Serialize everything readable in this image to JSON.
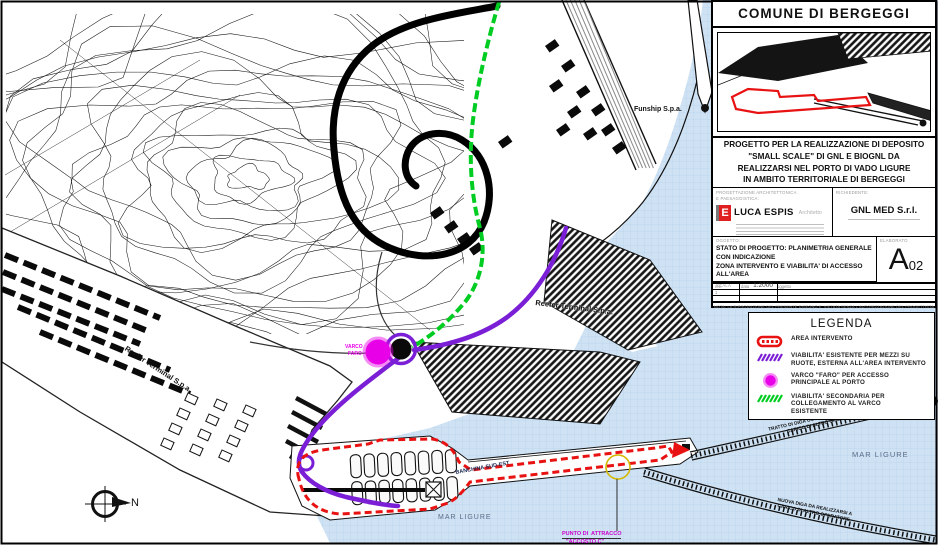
{
  "colors": {
    "sea": "#cfe2f4",
    "area_intervento": "#e81212",
    "viabilita_esistente": "#7a1fd6",
    "varco_faro": "#e800e8",
    "viabilita_secondaria": "#00cc22",
    "punto_attracco_label": "#cc00cc",
    "yellow_marker": "#d4b800",
    "logo_red": "#e02020"
  },
  "title_block": {
    "municipality": "COMUNE DI BERGEGGI",
    "project_title": "PROGETTO PER LA REALIZZAZIONE DI DEPOSITO\n\"SMALL SCALE\" DI GNL E BIOGNL DA\nREALIZZARSI NEL PORTO DI VADO LIGURE\nIN AMBITO TERRITORIALE DI BERGEGGI",
    "designer_caption": "PROGETTAZIONE  ARCHITETTONICA\nE  PAESAGGISTICA:",
    "designer_name": "LUCA ESPIS",
    "designer_role": "Architetto",
    "client_caption": "RICHIEDENTE:",
    "client_name": "GNL MED S.r.l.",
    "subject_caption": "OGGETTO:",
    "subject_text": "STATO DI PROGETTO: PLANIMETRIA GENERALE CON INDICAZIONE\nZONA INTERVENTO E VIABILITA' DI ACCESSO ALL'AREA",
    "scale_caption": "SCALA",
    "scale_value": "1:2000",
    "sheet_caption": "ELABORATO",
    "sheet_letter": "A",
    "sheet_number": "02",
    "revision_headers": {
      "rev": "rev.",
      "data": "data",
      "oggetto": "oggetto"
    },
    "revision_row1_rev": "1",
    "note": "NOTA: LA RIPRODUZIONE DEL PRESENTE DISEGNO E' VIETATA SENZA L'AUTORIZZAZIONE DEL PROGETTISTA"
  },
  "legend": {
    "title": "LEGENDA",
    "items": [
      {
        "symbol": "red-dashed-area",
        "label": "AREA INTERVENTO"
      },
      {
        "symbol": "purple-dashed-line",
        "label": "VIABILITA' ESISTENTE PER MEZZI SU\nRUOTE, ESTERNA ALL'AREA INTERVENTO"
      },
      {
        "symbol": "magenta-circle",
        "label": "VARCO \"FARO\" PER ACCESSO\nPRINCIPALE AL PORTO"
      },
      {
        "symbol": "green-dashed-line",
        "label": "VIABILITA' SECONDARIA PER\nCOLLEGAMENTO AL VARCO\nESISTENTE"
      }
    ]
  },
  "map": {
    "labels": {
      "funship": "Funship S.p.a.",
      "reefer_left": "Reefer Terminal S.p.a.",
      "reefer_right": "Reefer Terminal S.p.a.",
      "mar_ligure_bottom": "MAR LIGURE",
      "mar_ligure_right": "MAR LIGURE",
      "banchina": "BANCHINA SUD-EST",
      "punto_attracco_line1": "PUNTO DI  ATTRACCO",
      "punto_attracco_line2": "\"ACCOSTO C\"",
      "varco_line1": "VARCO",
      "varco_line2": "FARO",
      "diga_demolizione": "TRATTO DI DIGA OGGETTO DI DEMOLIZIONE A\nCARICO DI ALTRO OPERATORE",
      "nuova_diga": "NUOVA DIGA DA REALIZZARSI A\nCARICO DI ALTRO OPERATORE",
      "north": "N"
    }
  }
}
